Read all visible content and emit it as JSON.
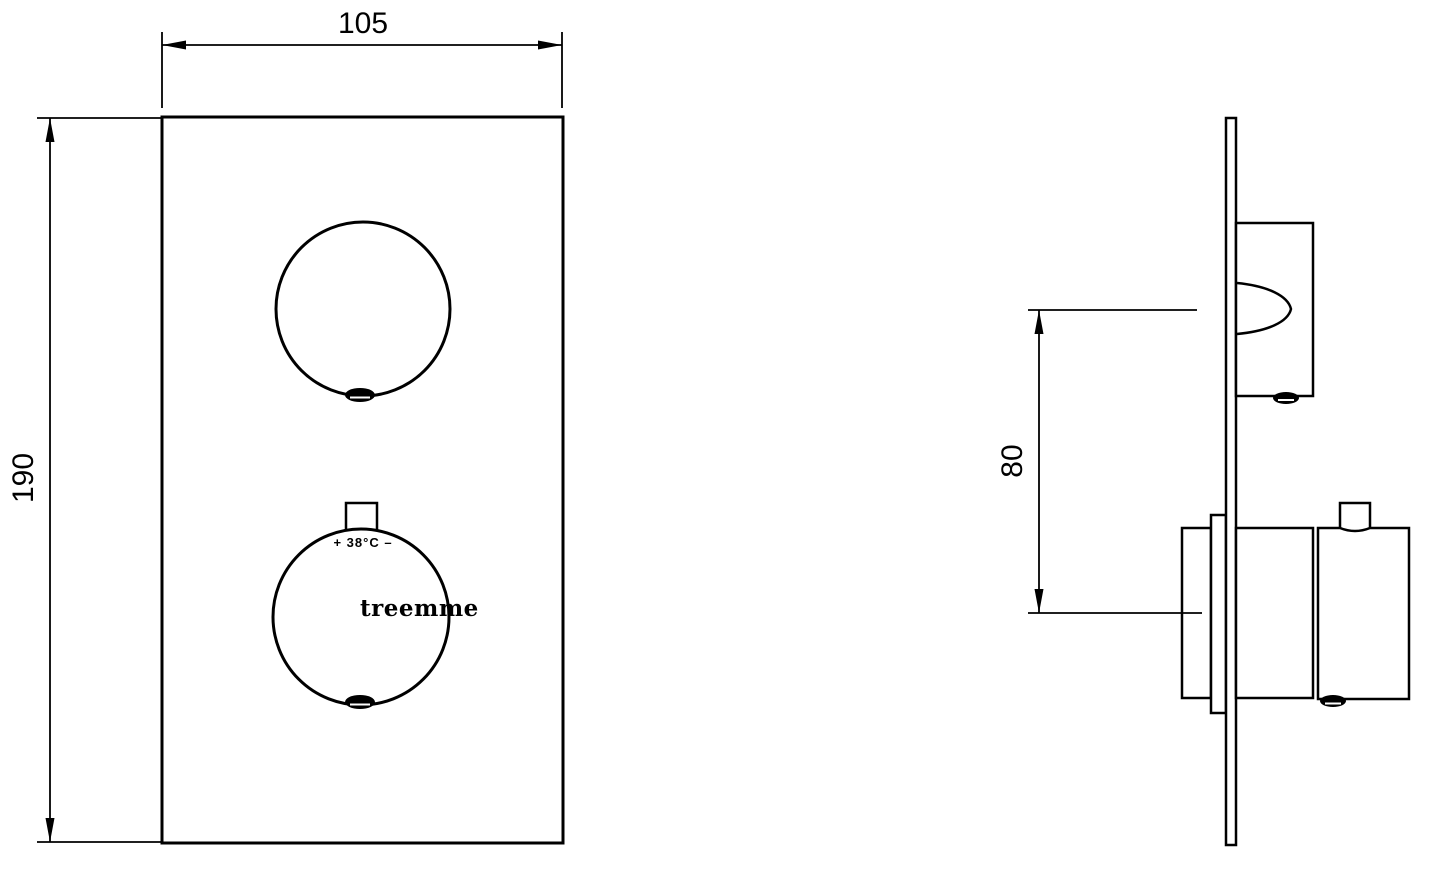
{
  "colors": {
    "background": "#ffffff",
    "line": "#000000"
  },
  "dimensions": {
    "front_width_mm": "105",
    "front_height_mm": "190",
    "handle_spacing_mm": "80"
  },
  "labels": {
    "temperature": "+ 38°C –",
    "brand": "treemme"
  }
}
